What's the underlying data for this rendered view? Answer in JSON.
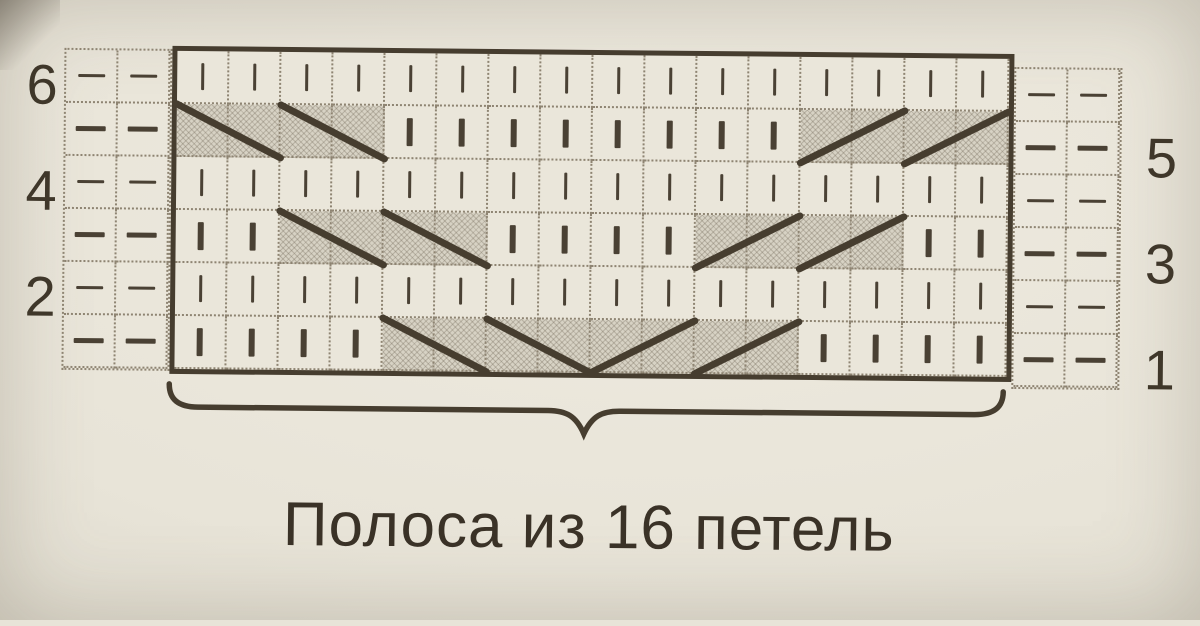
{
  "caption": {
    "text": "Полоса из 16 петель"
  },
  "colors": {
    "paper": "#e8e4d8",
    "ink": "#463d2f",
    "grid_dots": "#8e8472",
    "shaded_cell": "#d7d2c4"
  },
  "symbols": {
    "k": "knit-vertical-bar",
    "p": "purl-horizontal-dash",
    "s": "shaded-diagonal-span-cell"
  },
  "chart": {
    "pattern_columns": 16,
    "edge_columns_per_side": 2,
    "edge_symbol": "p",
    "rows": [
      {
        "number": "6",
        "number_side": "left",
        "weight": "thin",
        "main": [
          "k",
          "k",
          "k",
          "k",
          "k",
          "k",
          "k",
          "k",
          "k",
          "k",
          "k",
          "k",
          "k",
          "k",
          "k",
          "k"
        ],
        "diagonals": []
      },
      {
        "number": "5",
        "number_side": "right",
        "weight": "bold",
        "main": [
          "s",
          "s",
          "s",
          "s",
          "k",
          "k",
          "k",
          "k",
          "k",
          "k",
          "k",
          "k",
          "s",
          "s",
          "s",
          "s"
        ],
        "diagonals": [
          {
            "from": 1,
            "to": 2,
            "dir": "down"
          },
          {
            "from": 3,
            "to": 4,
            "dir": "down"
          },
          {
            "from": 13,
            "to": 14,
            "dir": "up"
          },
          {
            "from": 15,
            "to": 16,
            "dir": "up"
          }
        ]
      },
      {
        "number": "4",
        "number_side": "left",
        "weight": "thin",
        "main": [
          "k",
          "k",
          "k",
          "k",
          "k",
          "k",
          "k",
          "k",
          "k",
          "k",
          "k",
          "k",
          "k",
          "k",
          "k",
          "k"
        ],
        "diagonals": []
      },
      {
        "number": "3",
        "number_side": "right",
        "weight": "bold",
        "main": [
          "k",
          "k",
          "s",
          "s",
          "s",
          "s",
          "k",
          "k",
          "k",
          "k",
          "s",
          "s",
          "s",
          "s",
          "k",
          "k"
        ],
        "diagonals": [
          {
            "from": 3,
            "to": 4,
            "dir": "down"
          },
          {
            "from": 5,
            "to": 6,
            "dir": "down"
          },
          {
            "from": 11,
            "to": 12,
            "dir": "up"
          },
          {
            "from": 13,
            "to": 14,
            "dir": "up"
          }
        ]
      },
      {
        "number": "2",
        "number_side": "left",
        "weight": "thin",
        "main": [
          "k",
          "k",
          "k",
          "k",
          "k",
          "k",
          "k",
          "k",
          "k",
          "k",
          "k",
          "k",
          "k",
          "k",
          "k",
          "k"
        ],
        "diagonals": []
      },
      {
        "number": "1",
        "number_side": "right",
        "weight": "bold",
        "main": [
          "k",
          "k",
          "k",
          "k",
          "s",
          "s",
          "s",
          "s",
          "s",
          "s",
          "s",
          "s",
          "k",
          "k",
          "k",
          "k"
        ],
        "diagonals": [
          {
            "from": 5,
            "to": 6,
            "dir": "down"
          },
          {
            "from": 7,
            "to": 8,
            "dir": "down"
          },
          {
            "from": 9,
            "to": 10,
            "dir": "up"
          },
          {
            "from": 11,
            "to": 12,
            "dir": "up"
          }
        ]
      }
    ]
  }
}
